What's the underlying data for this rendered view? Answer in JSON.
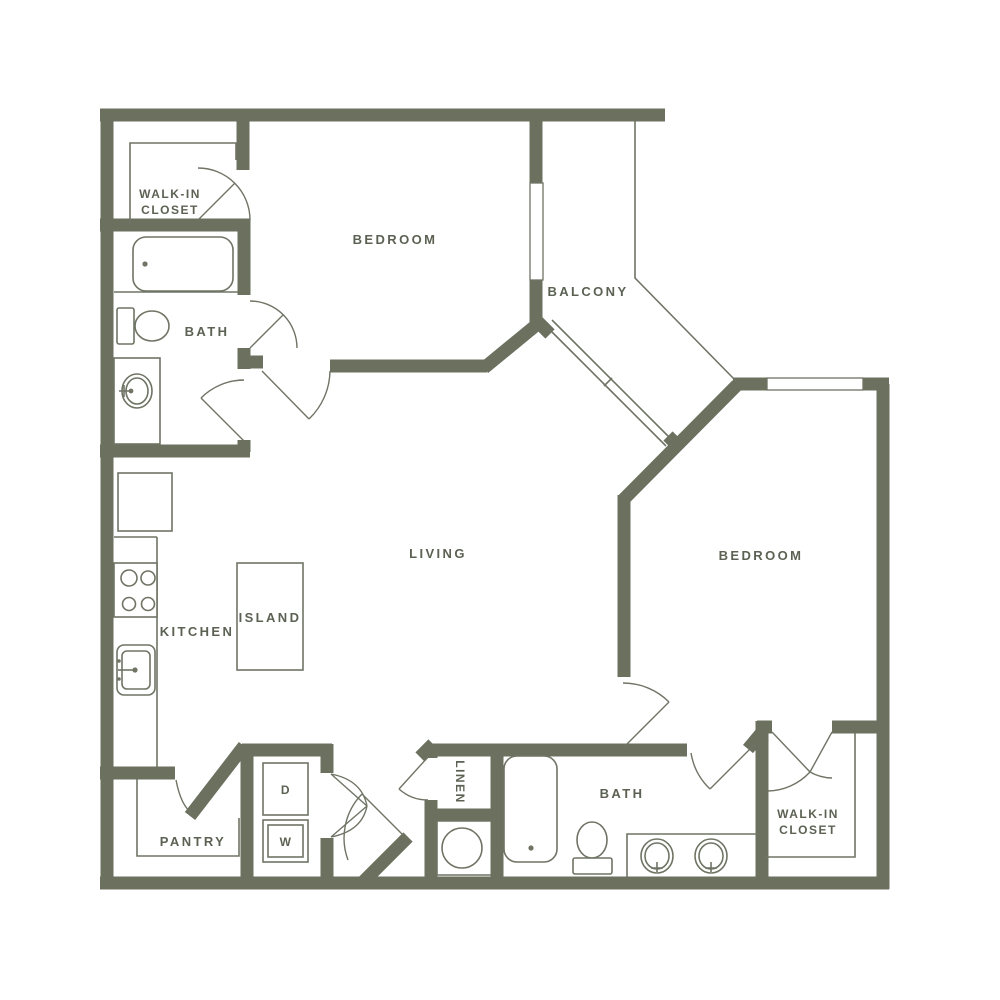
{
  "title": "Two bedroom two bath apartment floor plan",
  "colors": {
    "wall": "#6b705f",
    "thin_line": "#6f7465",
    "label_text": "#5c6253",
    "background": "#ffffff"
  },
  "rooms": {
    "walk_in_closet_top": {
      "label_line1": "WALK-IN",
      "label_line2": "CLOSET"
    },
    "bedroom_top": {
      "label": "BEDROOM"
    },
    "balcony": {
      "label": "BALCONY"
    },
    "bath_top": {
      "label": "BATH"
    },
    "kitchen": {
      "label": "KITCHEN"
    },
    "island": {
      "label": "ISLAND"
    },
    "living": {
      "label": "LIVING"
    },
    "bedroom_right": {
      "label": "BEDROOM"
    },
    "pantry": {
      "label": "PANTRY"
    },
    "linen": {
      "label": "LINEN"
    },
    "dryer": {
      "label": "D"
    },
    "washer": {
      "label": "W"
    },
    "bath_bottom": {
      "label": "BATH"
    },
    "walk_in_closet_bottom": {
      "label_line1": "WALK-IN",
      "label_line2": "CLOSET"
    }
  },
  "fixtures": [
    "bathtub-top",
    "toilet-top",
    "vanity-sink-top",
    "refrigerator",
    "stove",
    "kitchen-sink",
    "kitchen-island",
    "dryer",
    "washer",
    "water-heater",
    "linen-closet",
    "bathtub-bottom",
    "toilet-bottom",
    "double-vanity",
    "walk-in-closet-shelving"
  ]
}
